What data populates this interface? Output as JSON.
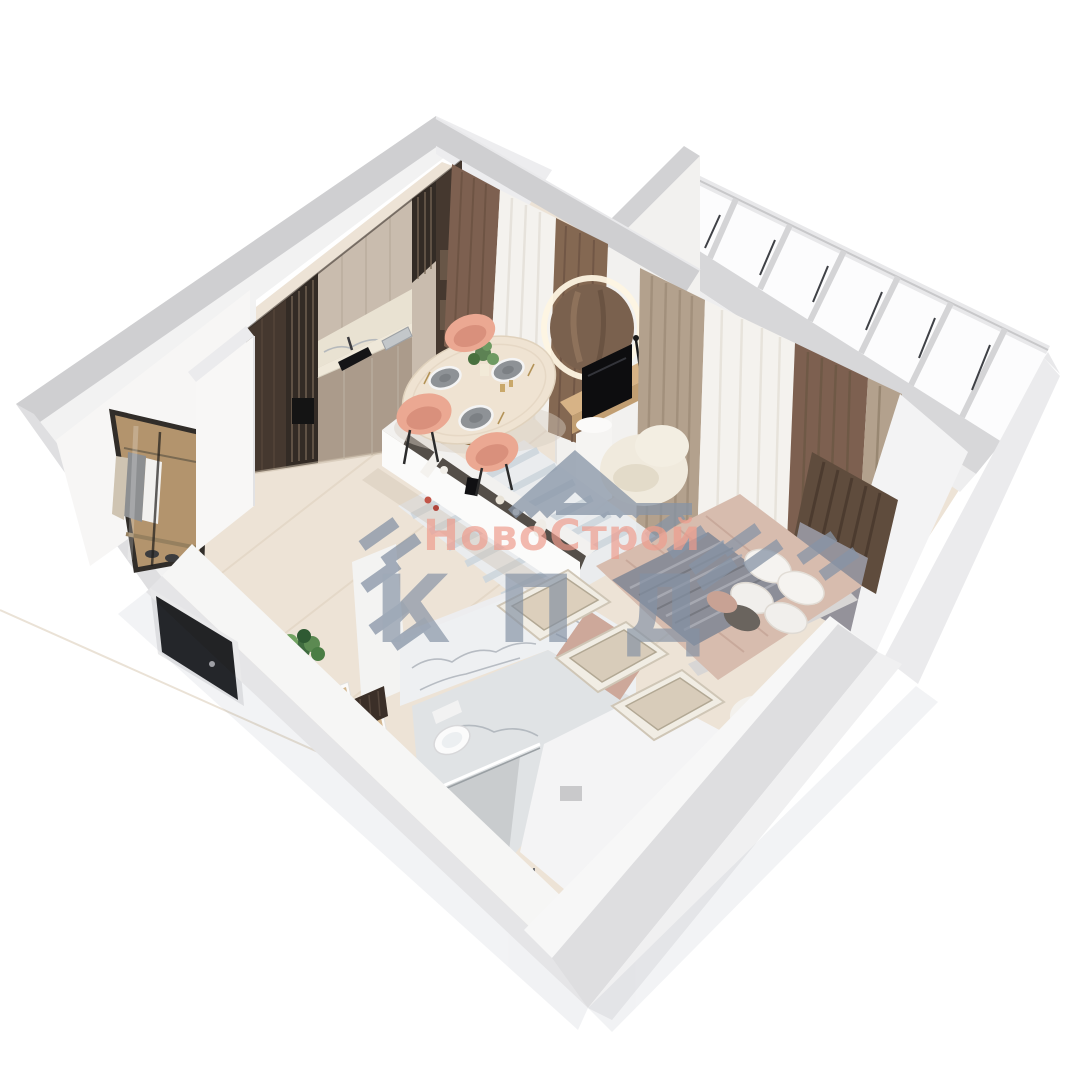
{
  "watermark": {
    "brand": "НовоСтрой",
    "abbr": "КПД",
    "accent_color": "#ee9c8d",
    "stripe_color": "#8492a5"
  },
  "palette": {
    "background": "#ffffff",
    "wall_top": "#cfcfd1",
    "wall_face": "#f5f5f6",
    "floor_wood": "#ede3d6",
    "floor_bathroom": "#e0e3e5",
    "kitchen_dark_wood": "#45382f",
    "kitchen_beige": "#c9bcae",
    "counter_marble": "#e9e2d2",
    "curtain_brown": "#7d6050",
    "curtain_taupe": "#b3a18d",
    "curtain_sheer": "#f4f2ee",
    "dining_chair_pink": "#eba892",
    "bedding_blush": "#d7bcae",
    "throw_gray": "#8c8e98",
    "marble_vein": "#a9afb7",
    "table_base_gold": "#b08a56"
  },
  "scene": {
    "type": "3d-floor-plan-render",
    "rooms": [
      {
        "name": "kitchen-living-room",
        "items": [
          "kitchen-cabinets",
          "sink",
          "cooktop",
          "dining-table",
          "dining-chairs",
          "window-curtains",
          "decor-console"
        ]
      },
      {
        "name": "bedroom",
        "items": [
          "double-bed",
          "pillows",
          "headboard",
          "vanity-mirror",
          "tv",
          "armchair",
          "pouf",
          "storage-benches",
          "rug",
          "curtains"
        ]
      },
      {
        "name": "balcony",
        "items": [
          "glazed-windows",
          "parapet"
        ]
      },
      {
        "name": "bathroom",
        "items": [
          "toilet",
          "marble-walls",
          "shower-glass",
          "bathtub-deck"
        ]
      },
      {
        "name": "hallway",
        "items": [
          "open-wardrobe",
          "entry-door",
          "console-cubes",
          "plant"
        ]
      }
    ]
  }
}
